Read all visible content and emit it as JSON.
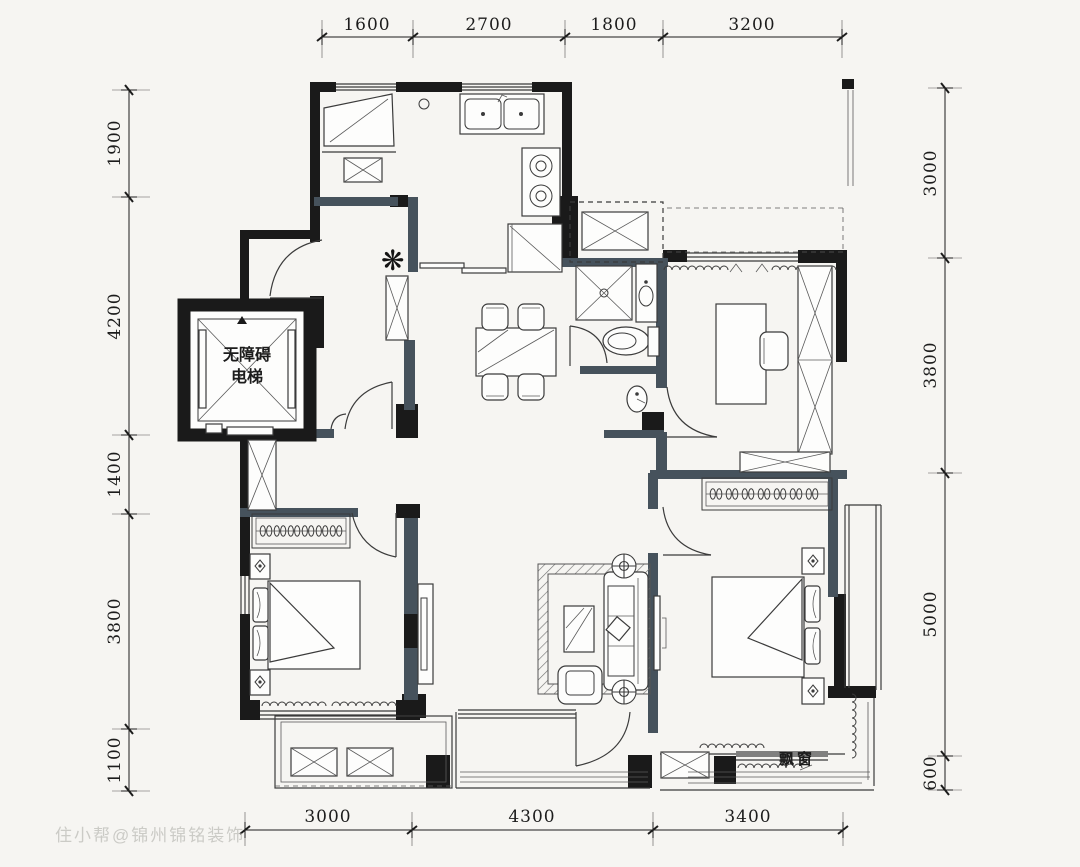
{
  "dimensions": {
    "top": [
      "1600",
      "2700",
      "1800",
      "3200"
    ],
    "left": [
      "1900",
      "4200",
      "1400",
      "3800",
      "1100"
    ],
    "right": [
      "3000",
      "3800",
      "5000",
      "600"
    ],
    "bottom": [
      "3000",
      "4300",
      "3400"
    ]
  },
  "labels": {
    "elevator_line1": "无障碍",
    "elevator_line2": "电梯",
    "bay_window": "飘窗",
    "watermark": "住小帮@锦州锦铭装饰"
  },
  "icons": {
    "plant": "❋"
  },
  "colors": {
    "background": "#f6f5f2",
    "wall": "#1a1a1a",
    "partition": "#46525c",
    "line": "#3b3b3b",
    "dim_text": "#1c1c1c"
  }
}
